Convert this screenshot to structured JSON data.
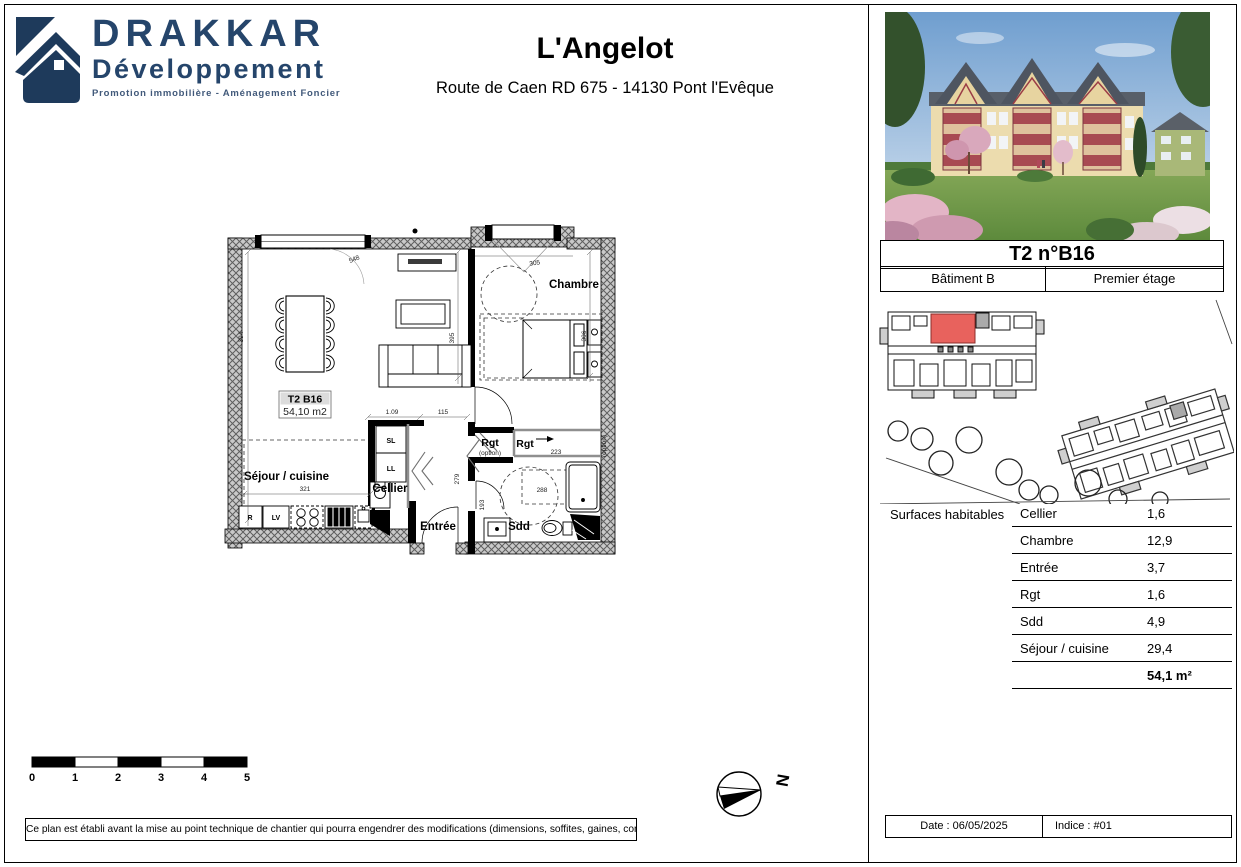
{
  "logo": {
    "name": "DRAKKAR",
    "subtitle": "Développement",
    "tagline": "Promotion immobilière - Aménagement Foncier",
    "color": "#25456b"
  },
  "header": {
    "title": "L'Angelot",
    "address": "Route de Caen RD 675 - 14130 Pont l'Evêque"
  },
  "floorplan": {
    "unit_label": "T2 B16",
    "unit_area": "54,10 m2",
    "rooms": {
      "sejour": "Séjour / cuisine",
      "chambre": "Chambre",
      "cellier": "Cellier",
      "entree": "Entrée",
      "sdd": "Sdd",
      "rgt1": "Rgt",
      "rgt1_note": "(option)",
      "rgt2": "Rgt",
      "option_side": "(option)"
    },
    "appliances": {
      "sl": "SL",
      "ll": "LL",
      "fridge": "R",
      "dishwasher": "LV"
    },
    "dimensions": {
      "top_window_sejour": "548",
      "top_window_chambre": "305",
      "left_height": "394",
      "mid_height": "395",
      "chambre_height": "306",
      "kitchen_width": "321",
      "hall_a": "1.09",
      "hall_b": "115",
      "rgt_width": "223",
      "sdd_width": "288",
      "entree_height": "279",
      "sdd_height": "193"
    }
  },
  "scalebar": {
    "labels": [
      "0",
      "1",
      "2",
      "3",
      "4",
      "5"
    ]
  },
  "compass": {
    "letter": "N"
  },
  "disclaimer": "Ce plan est établi avant la mise au point technique de chantier qui pourra engendrer des modifications (dimensions, soffites, gaines, conduits...)",
  "panel": {
    "unit_title": "T2 n°B16",
    "building": "Bâtiment B",
    "floor": "Premier étage",
    "highlight_color": "#e8625d",
    "surfaces": {
      "label": "Surfaces habitables",
      "rows": [
        {
          "name": "Cellier",
          "value": "1,6"
        },
        {
          "name": "Chambre",
          "value": "12,9"
        },
        {
          "name": "Entrée",
          "value": "3,7"
        },
        {
          "name": "Rgt",
          "value": "1,6"
        },
        {
          "name": "Sdd",
          "value": "4,9"
        },
        {
          "name": "Séjour / cuisine",
          "value": "29,4"
        }
      ],
      "total": "54,1 m²"
    },
    "footer": {
      "date": "Date : 06/05/2025",
      "indice": "Indice : #01"
    }
  }
}
